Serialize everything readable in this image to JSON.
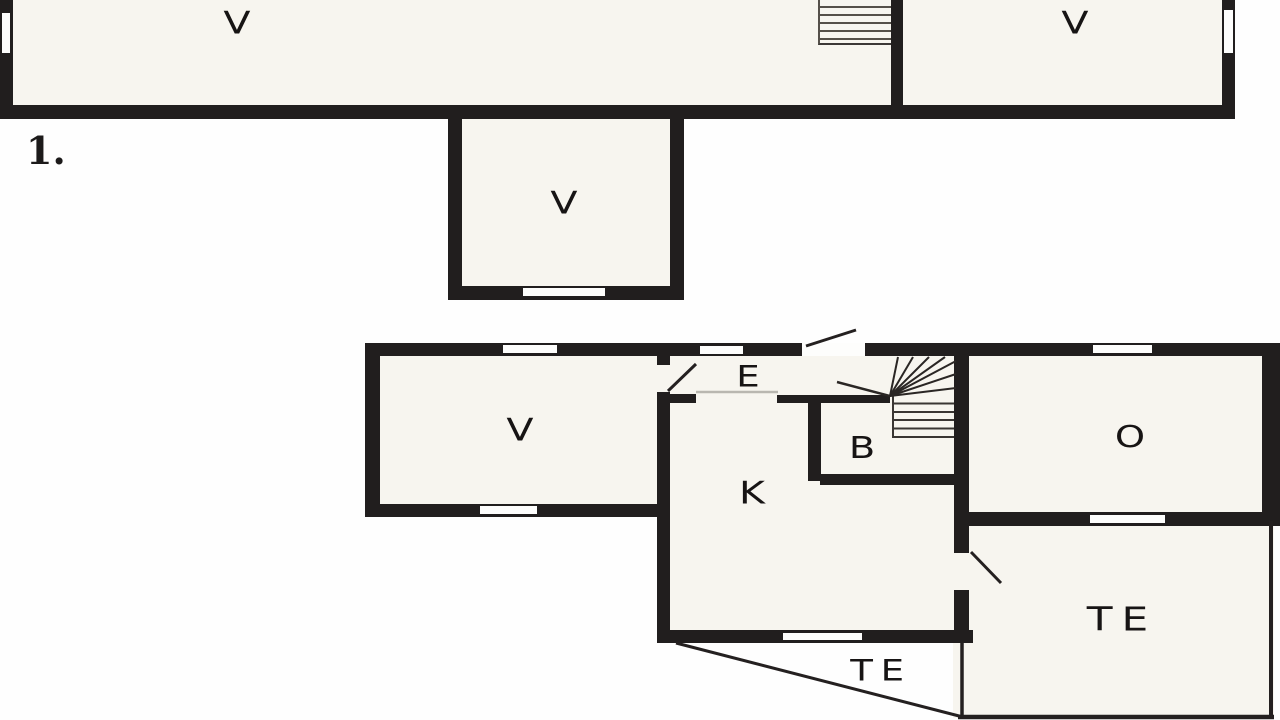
{
  "document_type": "floor-plan-drawing",
  "colors": {
    "wall": "#211e1e",
    "room_fill": "#f7f5ef",
    "background": "#fefefe",
    "stair_line": "#3a3633",
    "partition_light_line": "#b9b7b0"
  },
  "floors": [
    {
      "name": "upper-floor-strip",
      "floor_marker": "1.",
      "rooms": [
        {
          "key": "v-upper-left",
          "label": "V"
        },
        {
          "key": "v-upper-right",
          "label": "V"
        },
        {
          "key": "v-bay",
          "label": "V"
        }
      ],
      "features": [
        "straight-staircase",
        "left-wall-window",
        "right-wall-window",
        "bay-bottom-window"
      ]
    },
    {
      "name": "ground-floor",
      "rooms": [
        {
          "key": "v-living",
          "label": "V"
        },
        {
          "key": "e-entry",
          "label": "E"
        },
        {
          "key": "b-bath",
          "label": "B"
        },
        {
          "key": "k-kitchen",
          "label": "K"
        },
        {
          "key": "o-room",
          "label": "O"
        },
        {
          "key": "te-terrace-right",
          "label": "TE"
        },
        {
          "key": "te-terrace-triangle",
          "label": "TE"
        }
      ],
      "features": [
        "winder-staircase",
        "entry-door-swing",
        "room-door-swings",
        "five-windows",
        "triangular-terrace"
      ]
    }
  ]
}
